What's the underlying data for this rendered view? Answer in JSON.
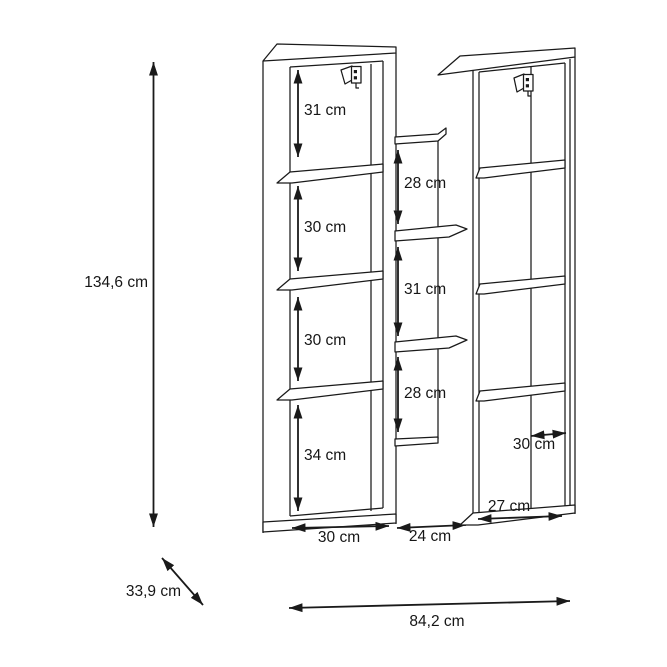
{
  "diagram": {
    "unit": "cm",
    "colors": {
      "line": "#1a1a1a",
      "background": "#ffffff"
    },
    "overall": {
      "height": "134,6 cm",
      "depth": "33,9 cm",
      "width": "84,2 cm"
    },
    "left_column": {
      "compartments": [
        "31 cm",
        "30 cm",
        "30 cm",
        "34 cm"
      ],
      "base_width": "30 cm"
    },
    "middle_section": {
      "compartments": [
        "28 cm",
        "31 cm",
        "28 cm"
      ],
      "base_width": "24 cm"
    },
    "right_column": {
      "inner_width": "30 cm",
      "base_width": "27 cm"
    }
  }
}
